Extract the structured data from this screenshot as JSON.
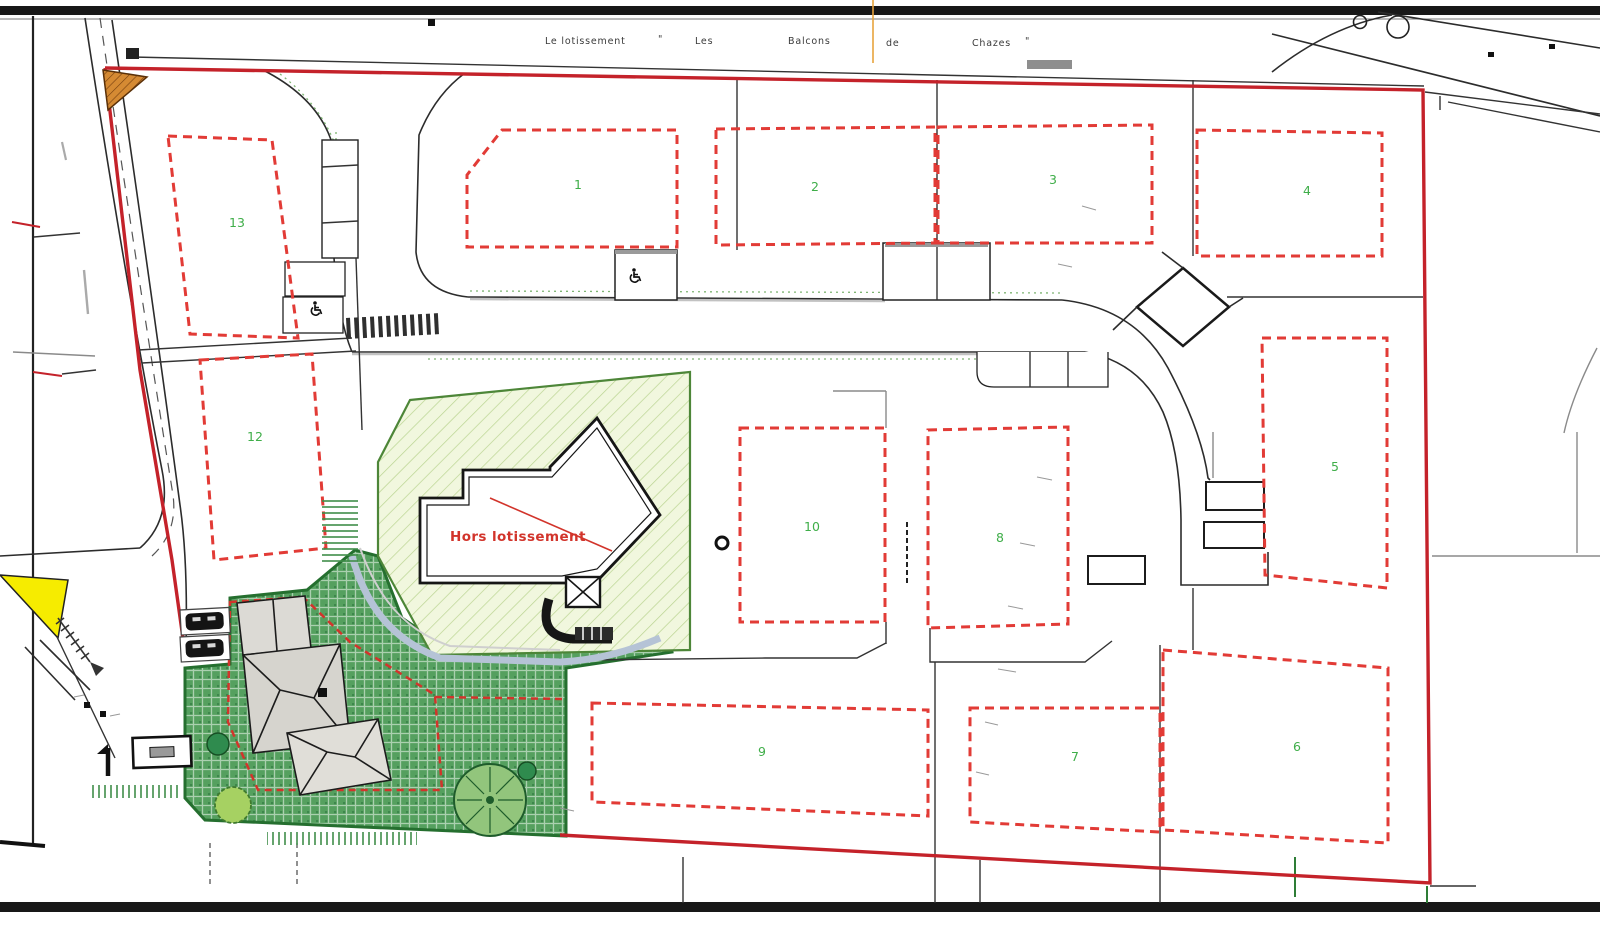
{
  "plan": {
    "title": {
      "words": [
        "Le lotissement",
        "\"",
        "Les",
        "Balcons",
        "de",
        "Chazes",
        "\""
      ]
    },
    "annotation": {
      "hors_lotissement": "Hors lotissement"
    },
    "lots": {
      "lot1": {
        "number": "1"
      },
      "lot2": {
        "number": "2"
      },
      "lot3": {
        "number": "3"
      },
      "lot4": {
        "number": "4"
      },
      "lot5": {
        "number": "5"
      },
      "lot6": {
        "number": "6"
      },
      "lot7": {
        "number": "7"
      },
      "lot8": {
        "number": "8"
      },
      "lot9": {
        "number": "9"
      },
      "lot10": {
        "number": "10"
      },
      "lot12": {
        "number": "12"
      },
      "lot13": {
        "number": "13"
      }
    },
    "icons": {
      "wheelchair": "accessible-parking-symbol",
      "manhole": "manhole-circle",
      "trees": "tree-crowns",
      "cars": "parked-car-symbols",
      "north_arrow": "small-arrow-marker"
    },
    "colors": {
      "site_boundary_red": "#c4222a",
      "lot_dash_red": "#e23b36",
      "lot_number_green": "#3fae49",
      "hors_area_fill": "#f1f7de",
      "hors_area_hatch": "#bad491",
      "lawn_green": "#55a05f",
      "lawn_border": "#256f2f",
      "path_blue_gray": "#b5c3d6",
      "highlight_yellow": "#f6ec00",
      "corner_orange": "#d58a33",
      "road_line_black": "#2c2c2c"
    }
  }
}
